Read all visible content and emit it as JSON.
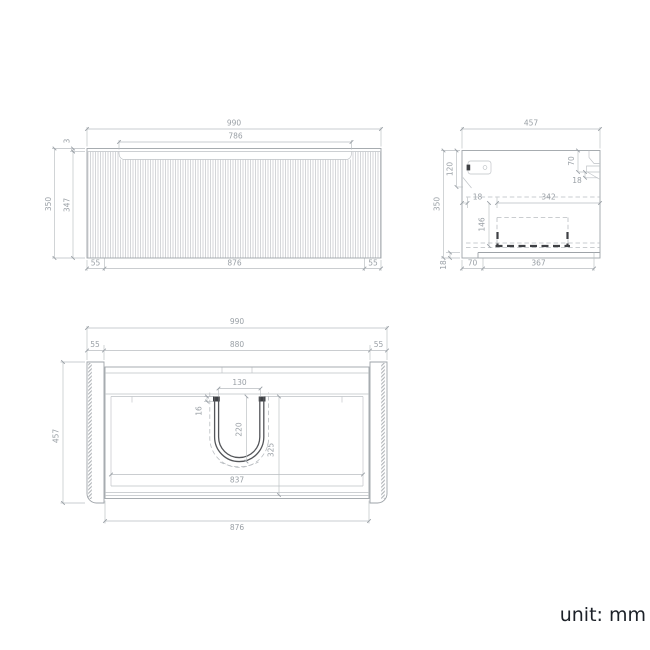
{
  "unit": {
    "label": "unit: mm"
  },
  "front_view": {
    "total_width": "990",
    "recess_width": "786",
    "top_lip": "3",
    "total_height": "350",
    "panel_height": "347",
    "left_gap": "55",
    "carcass_width": "876",
    "right_gap": "55"
  },
  "side_view": {
    "total_depth": "457",
    "total_height": "350",
    "hanger_drop": "120",
    "cleat_height": "70",
    "cleat_thickness": "18",
    "front_thickness": "18",
    "drawer_depth": "342",
    "drawer_height": "146",
    "bottom_thickness": "18",
    "toe_depth": "70",
    "base_depth": "367"
  },
  "plan_view": {
    "total_width": "990",
    "left_panel": "55",
    "inner_width": "880",
    "right_panel": "55",
    "total_depth": "457",
    "cutout_width": "130",
    "cutout_lip": "16",
    "cutout_depth": "220",
    "cutout_span": "325",
    "cavity_width": "837",
    "carcass_width": "876"
  }
}
